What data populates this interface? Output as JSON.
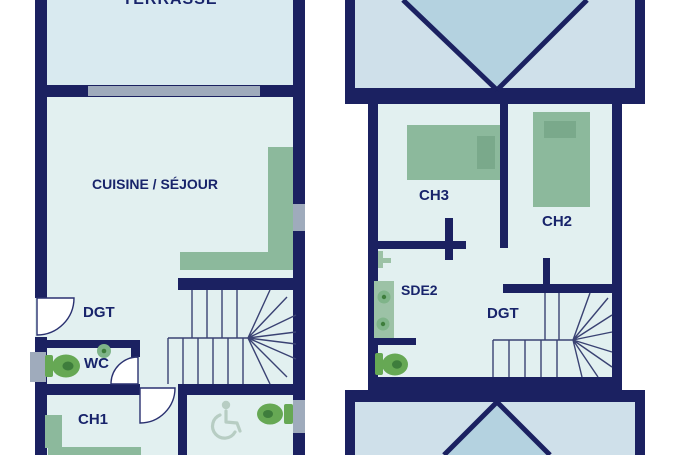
{
  "document": {
    "type": "architectural-floor-plan",
    "plan_count": 2
  },
  "plans": {
    "ground": {
      "terrasse": "TERRASSE",
      "cuisine_sejour": "CUISINE / SÉJOUR",
      "dgt": "DGT",
      "wc": "WC",
      "ch1": "CH1"
    },
    "upper": {
      "ch3": "CH3",
      "ch2": "CH2",
      "sde2": "SDE2",
      "dgt": "DGT"
    }
  },
  "icons": {
    "toilet-icon": "green oval bowl with tank, css/svg shape",
    "sink-icon": "green circle",
    "washbasin-unit-icon": "green rectangle with two basin circles",
    "shower-faucet-icon": "small green T shape",
    "wheelchair-accessible-icon": "stylized svg wheelchair glyph",
    "bed-icon": "green rectangle with darker pillow",
    "kitchen-counter-icon": "green L-shaped counter",
    "door-swing-icon": "white quarter-circle arc",
    "stairs-icon": "thin riser lines with winder fan",
    "window-icon": "gray bar in wall",
    "roof-icon": "light blue rectangle with navy hip diagonals"
  },
  "colors": {
    "wall": "#1b2161",
    "room_fill": "#e2f0f0",
    "terrace_fill": "#d9eaf0",
    "roof_fill": "#cfe0ea",
    "roof_shadow": "#b4d2e0",
    "furniture_green": "#8cb99c",
    "furniture_green_dark": "#7aa98b",
    "fixture_green": "#66a854",
    "fixture_green_dark": "#3e7d3c",
    "sink_green": "#7fb489",
    "basin_green": "#9cc2a6",
    "window_gray": "#9fabbc",
    "label_navy": "#18246b",
    "stair_line": "#3a4273",
    "door_stroke": "#2a3170",
    "accessible_icon": "#b7cdc3"
  }
}
